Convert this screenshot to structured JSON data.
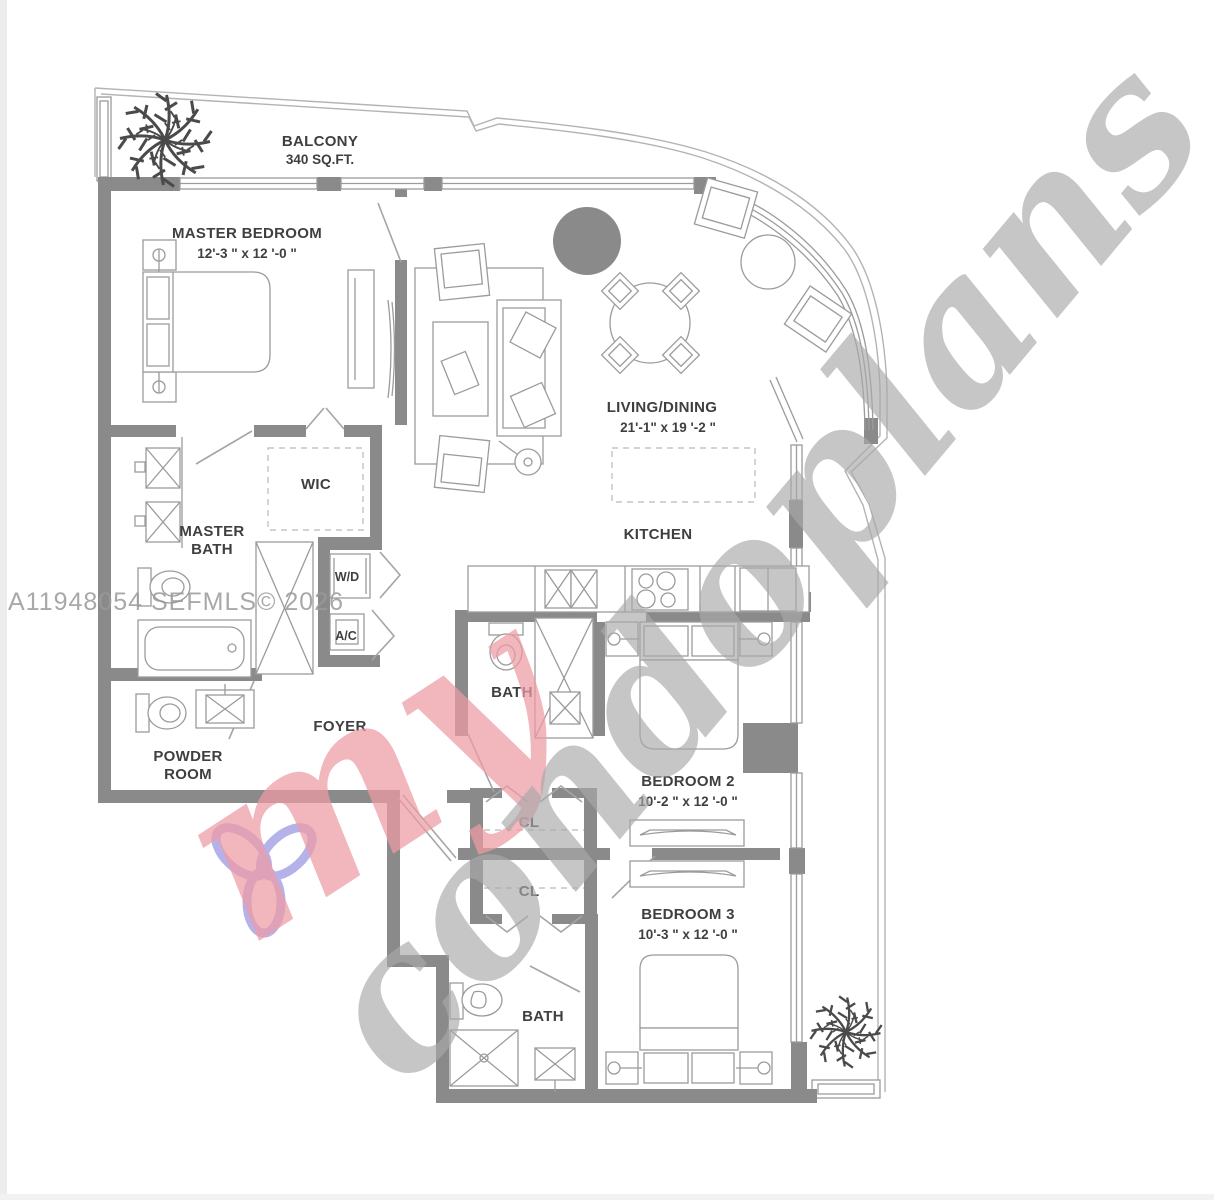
{
  "plan": {
    "balcony_label": "BALCONY",
    "balcony_area": "340 SQ.FT.",
    "master_bedroom": "MASTER BEDROOM",
    "master_bedroom_dims": "12'-3 \" x 12 '-0 \"",
    "living_dining": "LIVING/DINING",
    "living_dining_dims": "21'-1\" x 19 '-2 \"",
    "kitchen": "KITCHEN",
    "master_bath_line1": "MASTER",
    "master_bath_line2": "BATH",
    "wic": "WIC",
    "wd": "W/D",
    "ac": "A/C",
    "foyer": "FOYER",
    "powder_line1": "POWDER",
    "powder_line2": "ROOM",
    "bath2": "BATH",
    "bedroom2": "BEDROOM 2",
    "bedroom2_dims": "10'-2 \" x 12 '-0 \"",
    "cl_top": "CL",
    "cl_bottom": "CL",
    "bedroom3": "BEDROOM 3",
    "bedroom3_dims": "10'-3 \" x 12 '-0 \"",
    "bath3": "BATH"
  },
  "watermark": {
    "listing": "A11948054  SEFMLS© 2026",
    "brand_prefix": "my",
    "brand_suffix": "condoplans"
  },
  "colors": {
    "wall_gray": "#8a8a8a",
    "line_gray": "#9b9b9b",
    "watermark_gray": "#a9a9a9",
    "watermark_pink": "#ee9ba4",
    "watermark_purple": "#a3a0e6",
    "label_text": "#3f3f3f"
  }
}
